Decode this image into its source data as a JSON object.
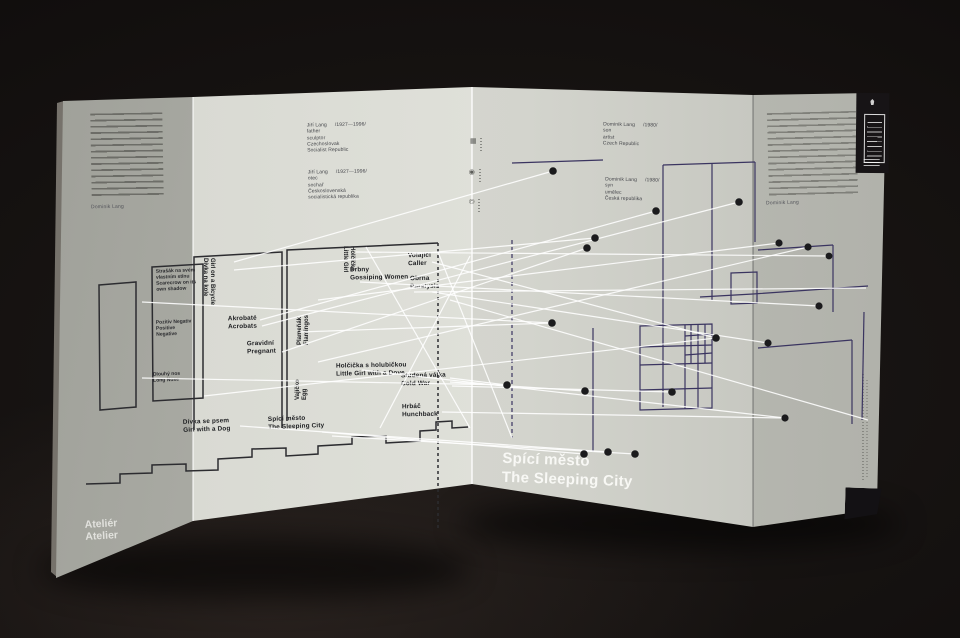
{
  "photo": {
    "object": "folded exhibition leaflet standing on dark surface"
  },
  "titles": {
    "white": {
      "cz": "Spící město",
      "en": "The Sleeping City"
    },
    "black": {
      "cz": "Spící město",
      "en": "The Sleeping City"
    },
    "atelier": {
      "cz": "Ateliér",
      "en": "Atelier"
    }
  },
  "credits": {
    "jiri_en": {
      "name": "Jiří Lang",
      "years": "/1927—1996/",
      "role": "father",
      "medium": "sculptor",
      "country1": "Czechoslovak",
      "country2": "Socialist Republic"
    },
    "jiri_cz": {
      "name": "Jiří Lang",
      "years": "/1927—1996/",
      "role": "otec",
      "medium": "sochař",
      "country1": "Československá",
      "country2": "socialistická republika"
    },
    "dominik_en": {
      "name": "Dominik Lang",
      "years": "/1980/",
      "role": "son",
      "medium": "artist",
      "country1": "Czech Republic"
    },
    "dominik_cz": {
      "name": "Dominik Lang",
      "years": "/1980/",
      "role": "syn",
      "medium": "umělec",
      "country1": "Česká republika"
    }
  },
  "intro": {
    "signature_cz": "Dominik Lang",
    "signature_en": "Dominik Lang"
  },
  "sculptures": [
    {
      "cz": "Strašák na svém vlastním stínu",
      "en": "Scarecrow on its own shadow"
    },
    {
      "cz": "Pozitiv Negativ",
      "en": "Positive Negative"
    },
    {
      "cz": "Dlouhý nos",
      "en": "Long Nose"
    },
    {
      "cz": "Dívka na kole",
      "en": "Girl on a Bicycle"
    },
    {
      "cz": "Akrobaté",
      "en": "Acrobats"
    },
    {
      "cz": "Gravidní",
      "en": "Pregnant"
    },
    {
      "cz": "Plameňák",
      "en": "Flamingos"
    },
    {
      "cz": "Vajíčko",
      "en": "Egg"
    },
    {
      "cz": "Holčička",
      "en": "Little Girl"
    },
    {
      "cz": "Drbny",
      "en": "Gossiping Women"
    },
    {
      "cz": "Volající",
      "en": "Caller"
    },
    {
      "cz": "Obrna",
      "en": "Paralysis"
    },
    {
      "cz": "Holčička s holubičkou",
      "en": "Little Girl with a Dove"
    },
    {
      "cz": "Studená válka",
      "en": "Cold War"
    },
    {
      "cz": "Hrbáč",
      "en": "Hunchback"
    },
    {
      "cz": "Dívka se psem",
      "en": "Girl with a Dog"
    }
  ],
  "icons": {
    "colophon_1": "grid-logo",
    "colophon_2": "circle-logo",
    "colophon_3": "copyright-mark",
    "gallery_logo": "gallery-logo-block"
  },
  "colors": {
    "paper_light": "#e0e1da",
    "paper_shadow": "#a0a19a",
    "map_line_navy": "#3a3460",
    "map_line_black": "#2c2c30",
    "connection_line_white": "#ffffff",
    "dot_black": "#1b1b1d",
    "background": "#0c0a09"
  }
}
